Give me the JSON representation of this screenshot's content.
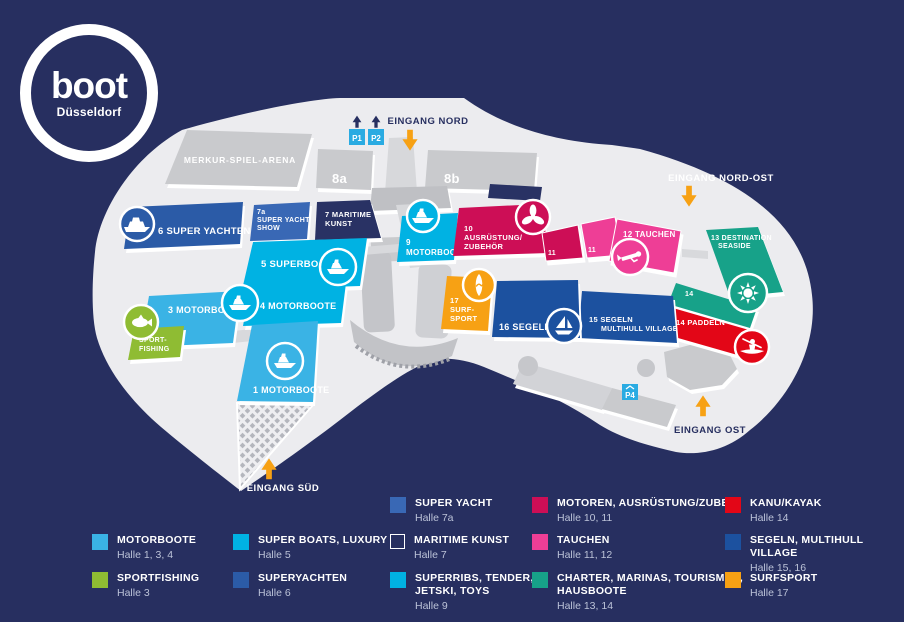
{
  "logo": {
    "brand": "boot",
    "city": "Düsseldorf"
  },
  "colors": {
    "background": "#272f60",
    "map": "#ececef",
    "building": "#c9cacd",
    "arrow": "#f7a114",
    "parking": "#2aabe2",
    "navy_text": "#272f60"
  },
  "entrances": {
    "nord": "EINGANG NORD",
    "nordost": "EINGANG NORD-OST",
    "ost": "EINGANG OST",
    "sued": "EINGANG SÜD"
  },
  "parking": {
    "p1": "P1",
    "p2": "P2",
    "p4": "P4"
  },
  "arena": {
    "label": "MERKUR-SPIEL-ARENA"
  },
  "halls": {
    "h8a": {
      "label": "8a",
      "color": "#c9cacd"
    },
    "h8b": {
      "label": "8b",
      "color": "#c9cacd"
    },
    "h6": {
      "label": "6 SUPER YACHTEN",
      "color": "#2b5ba7"
    },
    "h7a": {
      "lines": [
        "7a",
        "SUPER YACHT",
        "SHOW"
      ],
      "color": "#3968b5"
    },
    "h7": {
      "lines": [
        "7 MARITIME",
        "KUNST"
      ],
      "color": "#293264"
    },
    "h5": {
      "label": "5 SUPERBOATS",
      "color": "#00b2e3"
    },
    "h4": {
      "label": "4 MOTORBOOTE",
      "color": "#00b2e3"
    },
    "h3": {
      "label": "3 MOTORBOOTE",
      "color": "#3ab3e5"
    },
    "sportfishing": {
      "lines": [
        "SPORT-",
        "FISHING"
      ],
      "color": "#8fbc33"
    },
    "h1": {
      "label": "1 MOTORBOOTE",
      "color": "#3ab3e5"
    },
    "h9": {
      "lines": [
        "9",
        "MOTORBOOTE"
      ],
      "color": "#00b2e3"
    },
    "h10": {
      "lines": [
        "10",
        "AUSRÜSTUNG/",
        "ZUBEHÖR"
      ],
      "color": "#cd0e56"
    },
    "h11a": {
      "label": "11",
      "color": "#cd0e56"
    },
    "h11b": {
      "label": "11",
      "color": "#ee3e96"
    },
    "h12": {
      "label": "12 TAUCHEN",
      "color": "#ee3e96"
    },
    "h13": {
      "lines": [
        "13 DESTINATION",
        "SEASIDE"
      ],
      "color": "#17a289"
    },
    "h14": {
      "label": "14",
      "color": "#17a289"
    },
    "h14p": {
      "label": "14 PADDELN",
      "color": "#e30617"
    },
    "h15": {
      "lines": [
        "15 SEGELN",
        "MULTIHULL VILLAGE"
      ],
      "color": "#1c519f"
    },
    "h16": {
      "label": "16 SEGELN",
      "color": "#1c519f"
    },
    "h17": {
      "lines": [
        "17",
        "SURF-",
        "SPORT"
      ],
      "color": "#f7a114"
    }
  },
  "legend": {
    "items": [
      {
        "label": "MOTORBOOTE",
        "halls": "Halle 1, 3, 4",
        "color": "#3ab3e5"
      },
      {
        "label": "SPORTFISHING",
        "halls": "Halle 3",
        "color": "#8fbc33"
      },
      {
        "label": "SUPER BOATS, LUXURY",
        "halls": "Halle 5",
        "color": "#00b2e3"
      },
      {
        "label": "SUPERYACHTEN",
        "halls": "Halle 6",
        "color": "#2b5ba7"
      },
      {
        "label": "SUPER YACHT",
        "halls": "Halle 7a",
        "color": "#3968b5"
      },
      {
        "label": "MARITIME KUNST",
        "halls": "Halle 7",
        "color": "#272f60"
      },
      {
        "label": "SUPERRIBS, TENDER, JETSKI, TOYS",
        "halls": "Halle 9",
        "color": "#00b2e3"
      },
      {
        "label": "MOTOREN, AUSRÜSTUNG/ZUBE-",
        "halls": "Halle 10, 11",
        "color": "#cd0e56"
      },
      {
        "label": "TAUCHEN",
        "halls": "Halle 11, 12",
        "color": "#ee3e96"
      },
      {
        "label": "CHARTER, MARINAS, TOURISMUS, HAUSBOOTE",
        "halls": "Halle 13, 14",
        "color": "#17a289"
      },
      {
        "label": "KANU/KAYAK",
        "halls": "Halle 14",
        "color": "#e30617"
      },
      {
        "label": "SEGELN, MULTIHULL VILLAGE",
        "halls": "Halle 15, 16",
        "color": "#1c519f"
      },
      {
        "label": "SURFSPORT",
        "halls": "Halle 17",
        "color": "#f7a114"
      }
    ]
  }
}
